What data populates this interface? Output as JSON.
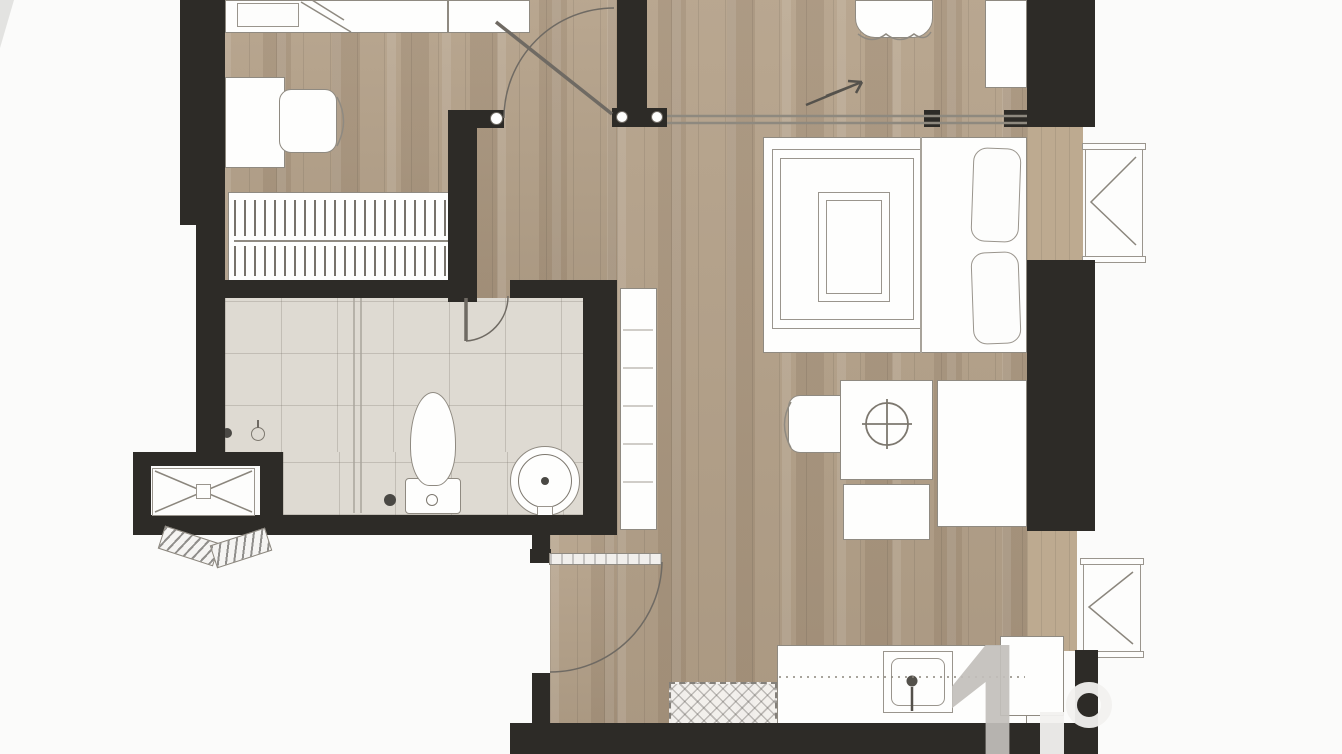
{
  "document": {
    "type": "floor-plan",
    "description": "Top-down architectural floor plan of a two-bedroom apartment unit, cropped at the top edge; no text labels or dimensions visible",
    "text_visible": false
  },
  "colors": {
    "background": "#fbfbfa",
    "wall": "#2d2b27",
    "wood_floor": "#b5a28a",
    "wood_floor_light": "#c9bba4",
    "wood_floor_dark": "#99876e",
    "tile_floor": "#dedad2",
    "tile_grid_line": "#b9b4aa",
    "furniture_fill": "#fefefd",
    "furniture_outline": "#8f8a81",
    "glass_line": "#a9a49b",
    "sliding_track": "#8e897f",
    "watermark_grey": "#c2bfbb",
    "watermark_white": "#f2f1ef"
  },
  "rooms": [
    {
      "name": "bedroom-2",
      "floor": "wood",
      "contents": [
        "single-bed",
        "pillow",
        "blanket-fold",
        "desk",
        "office-chair",
        "built-in-wardrobe-with-hanging-clothes"
      ]
    },
    {
      "name": "hallway",
      "floor": "wood",
      "contents": [
        "bedroom-door-swing-arc",
        "door-stop-posts"
      ]
    },
    {
      "name": "bathroom",
      "floor": "tile",
      "contents": [
        "shower-glass-partition",
        "floor-drain",
        "wall-tap",
        "toilet-with-cistern",
        "round-pedestal-basin",
        "door-swing-arc"
      ]
    },
    {
      "name": "master-bedroom",
      "floor": "wood",
      "contents": [
        "double-bed",
        "duvet-inner-panel",
        "two-pillows",
        "dressing-table",
        "round-mirror-ornament",
        "stool",
        "scalloped-chair",
        "wardrobe",
        "tall-shelf-console"
      ]
    },
    {
      "name": "upper-strip",
      "floor": "wood",
      "contents": [
        "scalloped-armchair",
        "wall-cabinet",
        "sliding-door-track",
        "slide-direction-arrow"
      ]
    },
    {
      "name": "kitchen-entry",
      "floor": "wood",
      "contents": [
        "entry-door-leaf",
        "entry-door-swing-arc",
        "kitchen-counter",
        "counter-sink-with-faucet",
        "dashed-built-under-appliance",
        "refrigerator-cabinet"
      ]
    },
    {
      "name": "exterior",
      "contents": [
        "ac-condenser-niche-with-x-brace",
        "louvered-access-flaps",
        "ac-unit-upper-right",
        "ac-unit-lower-right",
        "wood-ac-ledges"
      ]
    }
  ],
  "watermark": {
    "present": true,
    "position": "bottom-right-corner",
    "style": "partial grey and white logo glyphs",
    "secondary_mark": "small grey sliver at top-left corner"
  }
}
